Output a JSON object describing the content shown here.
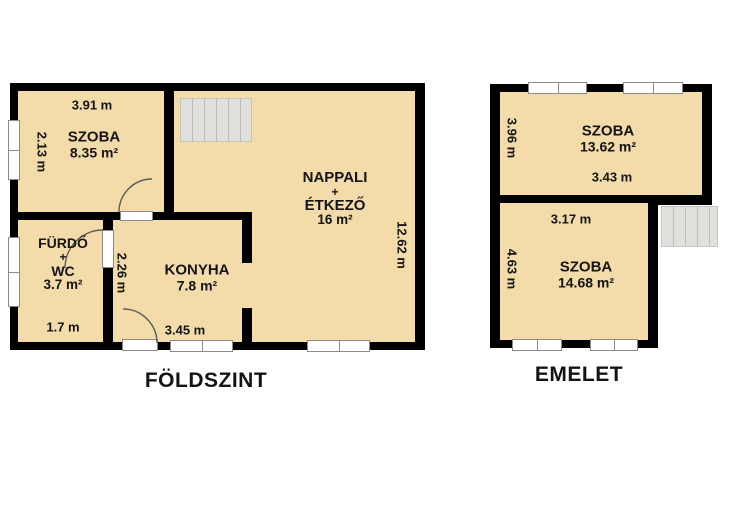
{
  "colors": {
    "room_fill": "#F4DBAA",
    "wall": "#000000",
    "stairs_fill": "#E2E0DC",
    "stairs_line": "#BDBBB7",
    "window_fill": "#FFFFFF",
    "window_frame": "#8A8A8A",
    "text": "#141414"
  },
  "foldszint": {
    "title": "FÖLDSZINT",
    "szoba": {
      "name": "SZOBA",
      "area": "8.35 m²"
    },
    "furdo": {
      "name": "FÜRDŐ",
      "plus": "+",
      "name2": "WC",
      "area": "3.7 m²"
    },
    "konyha": {
      "name": "KONYHA",
      "area": "7.8 m²"
    },
    "nappali": {
      "name": "NAPPALI",
      "plus": "+",
      "name2": "ÉTKEZŐ",
      "area": "16 m²"
    },
    "dim_szoba_width": "3.91 m",
    "dim_szoba_height": "2.13 m",
    "dim_furdo_width": "1.7 m",
    "dim_konyha_height": "2.26 m",
    "dim_konyha_width": "3.45 m",
    "dim_nappali_height": "12.62 m"
  },
  "emelet": {
    "title": "EMELET",
    "szoba_felso": {
      "name": "SZOBA",
      "area": "13.62 m²"
    },
    "szoba_also": {
      "name": "SZOBA",
      "area": "14.68 m²"
    },
    "dim_felso_height": "3.96 m",
    "dim_felso_width": "3.43 m",
    "dim_also_width": "3.17 m",
    "dim_also_height": "4.63 m"
  }
}
